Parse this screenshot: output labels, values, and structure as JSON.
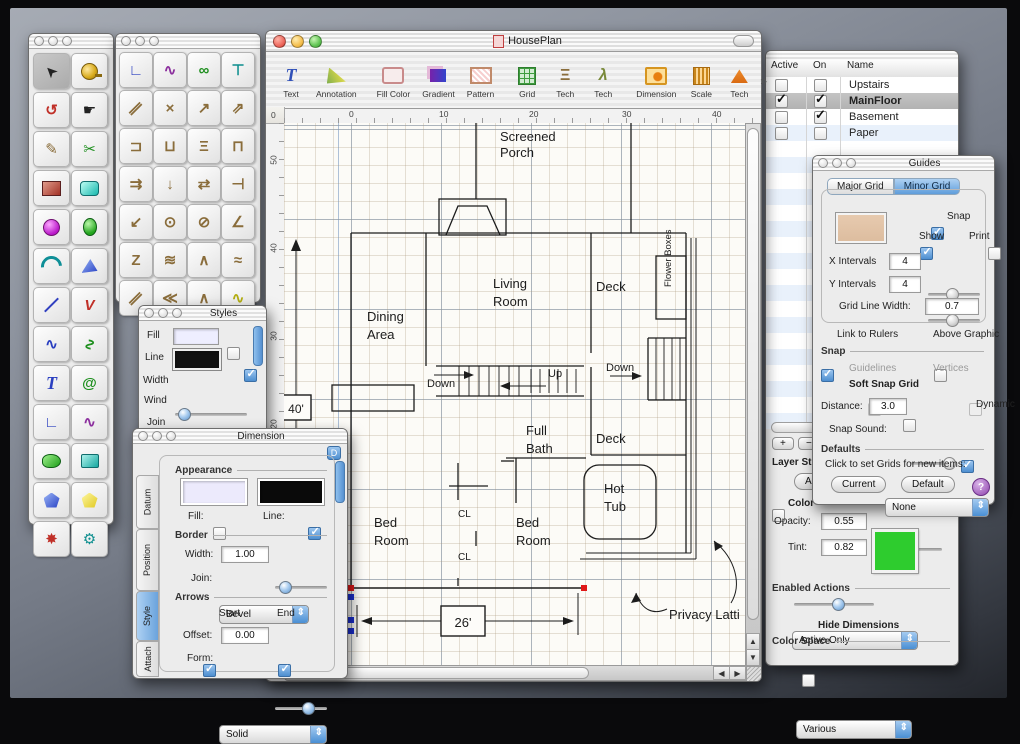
{
  "doc": {
    "title": "HousePlan",
    "toolbar": {
      "items": [
        {
          "label": "Text",
          "glyph": "T"
        },
        {
          "label": "Annotation"
        },
        {
          "label": "Fill Color"
        },
        {
          "label": "Gradient"
        },
        {
          "label": "Pattern"
        },
        {
          "label": "Grid"
        },
        {
          "label": "Tech",
          "glyph": "Ξ"
        },
        {
          "label": "Tech",
          "glyph": "λ"
        },
        {
          "label": "Dimension"
        },
        {
          "label": "Scale"
        },
        {
          "label": "Tech"
        }
      ],
      "overflow": "»"
    },
    "ruler_corner": "0",
    "ruler_h": [
      "0",
      "10",
      "20",
      "30",
      "40"
    ],
    "ruler_v": [
      "50",
      "40",
      "30",
      "20"
    ],
    "plan": {
      "screened_1": "Screened",
      "screened_2": "Porch",
      "living_1": "Living",
      "living_2": "Room",
      "deck_top": "Deck",
      "deck_low": "Deck",
      "dining_1": "Dining",
      "dining_2": "Area",
      "flower_boxes": "Flower Boxes",
      "down_center": "Down",
      "up": "Up",
      "down_right": "Down",
      "full_1": "Full",
      "full_2": "Bath",
      "hot_1": "Hot",
      "hot_2": "Tub",
      "bed1_1": "Bed",
      "bed1_2": "Room",
      "bed2_1": "Bed",
      "bed2_2": "Room",
      "cl_1": "CL",
      "cl_2": "CL",
      "dim_width": "26'",
      "dim_height": "40'",
      "privacy": "Privacy Latti"
    }
  },
  "layers": {
    "columns": [
      "Active",
      "On",
      "Name"
    ],
    "rows": [
      {
        "name": "Upstairs",
        "active": false,
        "on": false
      },
      {
        "name": "MainFloor",
        "active": true,
        "on": true
      },
      {
        "name": "Basement",
        "active": false,
        "on": true
      },
      {
        "name": "Paper",
        "active": false,
        "on": false
      }
    ],
    "add": "+",
    "remove": "−",
    "layer_status": "Layer St",
    "all_btn": "Ac",
    "color_label": "Color",
    "opacity_label": "Opacity:",
    "opacity_value": "0.55",
    "tint_label": "Tint:",
    "tint_value": "0.82",
    "tint_color": "#2ecc2e",
    "enabled_actions_label": "Enabled Actions",
    "enabled_actions_value": "Active Only",
    "hide_dimensions_label": "Hide Dimensions",
    "color_space_label": "Color Space",
    "color_space_value": "Various"
  },
  "guides": {
    "title": "Guides",
    "tabs": [
      "Major Grid",
      "Minor Grid"
    ],
    "snap_cb": "Snap",
    "show_cb": "Show",
    "print_cb": "Print",
    "x_intervals_label": "X Intervals",
    "x_intervals_value": "4",
    "y_intervals_label": "Y Intervals",
    "y_intervals_value": "4",
    "grid_line_width_label": "Grid Line Width:",
    "grid_line_width_value": "0.7",
    "link_rulers": "Link  to Rulers",
    "above_graphic": "Above Graphic",
    "snap_section": "Snap",
    "guidelines": "Guidelines",
    "vertices": "Vertices",
    "soft_snap": "Soft Snap Grid",
    "distance_label": "Distance:",
    "distance_value": "3.0",
    "dynamic": "Dynamic",
    "snap_sound_label": "Snap Sound:",
    "snap_sound_value": "None",
    "defaults_section": "Defaults",
    "defaults_hint": "Click to set Grids for new items:",
    "current_btn": "Current",
    "default_btn": "Default",
    "help": "?"
  },
  "dimension": {
    "title": "Dimension",
    "badge": "D",
    "tabs": [
      "Datum",
      "Position",
      "Style",
      "Attach"
    ],
    "appearance": "Appearance",
    "fill_label": "Fill:",
    "line_label": "Line:",
    "border": "Border",
    "width_label": "Width:",
    "width_value": "1.00",
    "join_label": "Join:",
    "join_value": "Bevel",
    "arrows": "Arrows",
    "start_cb": "Start",
    "end_cb": "End",
    "offset_label": "Offset:",
    "offset_value": "0.00",
    "form_label": "Form:",
    "form_value": "Solid"
  },
  "styles": {
    "title": "Styles",
    "fill_label": "Fill",
    "line_label": "Line",
    "width_label": "Width",
    "wind_label": "Wind",
    "wind_value": "Non-Ze",
    "join_label": "Join",
    "join_value": "Miter",
    "cap_label": "Cap",
    "cap_value": "Square"
  },
  "tools1": [
    {
      "name": "cursor",
      "glyph": "➤"
    },
    {
      "name": "tape-measure",
      "glyph": ""
    },
    {
      "name": "rotate",
      "glyph": "↺"
    },
    {
      "name": "hand",
      "glyph": "☛"
    },
    {
      "name": "brush",
      "glyph": "✎"
    },
    {
      "name": "scissors",
      "glyph": "✂"
    },
    {
      "name": "rectangle",
      "glyph": ""
    },
    {
      "name": "rounded-rectangle",
      "glyph": ""
    },
    {
      "name": "circle",
      "glyph": ""
    },
    {
      "name": "ellipse",
      "glyph": ""
    },
    {
      "name": "arc",
      "glyph": ""
    },
    {
      "name": "wedge",
      "glyph": ""
    },
    {
      "name": "line",
      "glyph": ""
    },
    {
      "name": "polyline",
      "glyph": "V"
    },
    {
      "name": "curve",
      "glyph": "∿"
    },
    {
      "name": "freehand",
      "glyph": "∿"
    },
    {
      "name": "text",
      "glyph": "T"
    },
    {
      "name": "spiral",
      "glyph": "@"
    },
    {
      "name": "corner-path",
      "glyph": "∟"
    },
    {
      "name": "bezier",
      "glyph": "∿"
    },
    {
      "name": "closed-curve",
      "glyph": ""
    },
    {
      "name": "closed-path",
      "glyph": ""
    },
    {
      "name": "pentagon",
      "glyph": ""
    },
    {
      "name": "polygon",
      "glyph": ""
    },
    {
      "name": "star",
      "glyph": "✸"
    },
    {
      "name": "gear",
      "glyph": "⚙"
    }
  ],
  "tools2": [
    {
      "glyph": "∟"
    },
    {
      "glyph": "∿"
    },
    {
      "glyph": "∞"
    },
    {
      "glyph": "⊤"
    },
    {
      "glyph": "∥"
    },
    {
      "glyph": "×"
    },
    {
      "glyph": "↗"
    },
    {
      "glyph": "⇗"
    },
    {
      "glyph": "⊐"
    },
    {
      "glyph": "⊔"
    },
    {
      "glyph": "Ξ"
    },
    {
      "glyph": "⊓"
    },
    {
      "glyph": "⇉"
    },
    {
      "glyph": "↓"
    },
    {
      "glyph": "⇄"
    },
    {
      "glyph": "⊣"
    },
    {
      "glyph": "↙"
    },
    {
      "glyph": "⊙"
    },
    {
      "glyph": "⊘"
    },
    {
      "glyph": "∠"
    },
    {
      "glyph": "Z"
    },
    {
      "glyph": "≋"
    },
    {
      "glyph": "∧"
    },
    {
      "glyph": "≈"
    },
    {
      "glyph": "∥"
    },
    {
      "glyph": "≪"
    },
    {
      "glyph": "∧"
    },
    {
      "glyph": "∿"
    }
  ]
}
